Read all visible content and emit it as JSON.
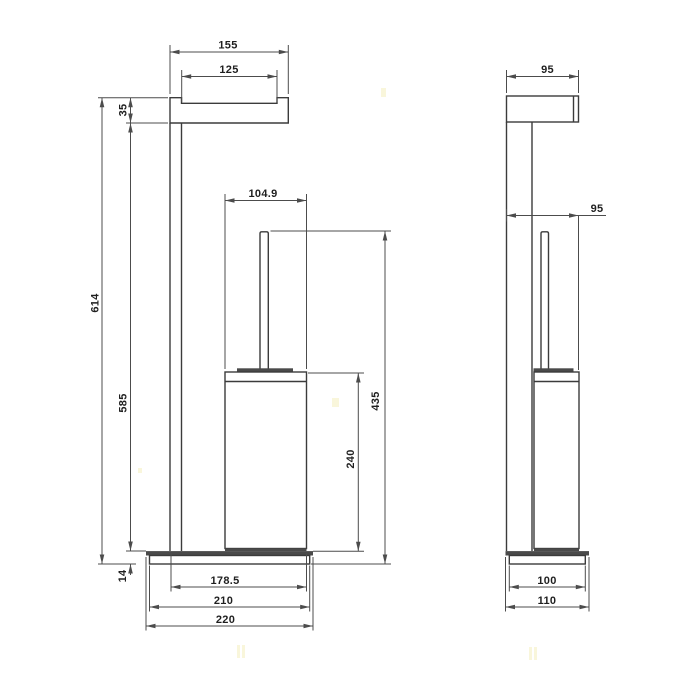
{
  "colors": {
    "background": "#ffffff",
    "line": "#3b3b3b",
    "dim": "#4c4c4c",
    "text": "#1f1f1f",
    "fill_dark": "#4a4a4a",
    "watermark": "#f2ecb0"
  },
  "drawing": {
    "views": {
      "front": {
        "dims": {
          "arm_width": "155",
          "arm_recess_width": "125",
          "arm_height": "35",
          "overall_height": "614",
          "post_height": "585",
          "base_height": "14",
          "container_width": "104.9",
          "brush_height": "435",
          "container_height": "240",
          "base_span_width": "178.5",
          "base_body_width": "210",
          "base_plate_width": "220"
        }
      },
      "side": {
        "dims": {
          "arm_depth": "95",
          "body_depth": "95",
          "base_body_depth": "100",
          "base_plate_depth": "110"
        }
      }
    }
  }
}
